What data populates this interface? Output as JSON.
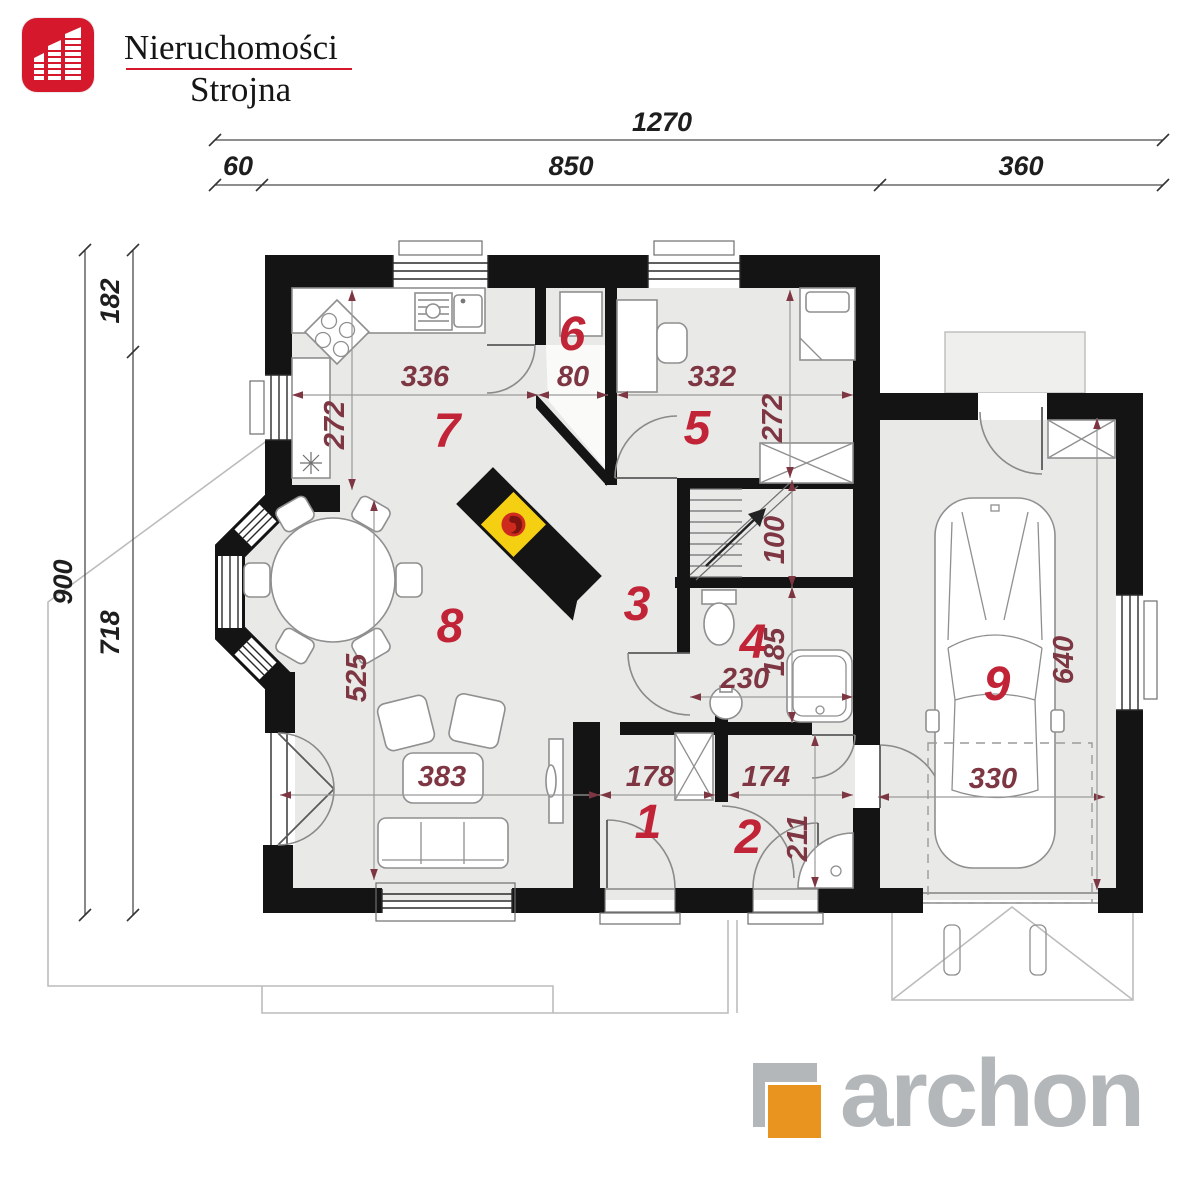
{
  "colors": {
    "accent-red": "#d6182c",
    "wall": "#141414",
    "floor": "#e9e9e7",
    "room-number": "#c22437",
    "dim-red": "#7d3642",
    "fireplace-yellow": "#f5cf12",
    "flame-red": "#cf2a1e",
    "archon-gray": "#b3b7b9",
    "archon-orange": "#e8941f",
    "outline-gray": "#bcbcbc"
  },
  "header_logo": {
    "line1": "Nieruchomości",
    "line2": "Strojna"
  },
  "footer_logo": {
    "text": "archon"
  },
  "outer_dimensions": {
    "total_width": "1270",
    "left_setback": "60",
    "house_width": "850",
    "garage_width": "360",
    "total_depth": "900",
    "upper_depth": "182",
    "lower_depth": "718"
  },
  "interior_dimensions": {
    "kitchen_width": "336",
    "kitchen_depth": "272",
    "pantry_width": "80",
    "bedroom_width": "332",
    "bedroom_depth": "272",
    "living_length": "525",
    "living_width": "383",
    "hall_width": "178",
    "stair_passage": "100",
    "bathroom_depth": "185",
    "bathroom_width": "230",
    "vestibule_width": "174",
    "vestibule_depth": "211",
    "garage_gate_width": "330",
    "garage_depth": "640"
  },
  "rooms": [
    {
      "number": "1"
    },
    {
      "number": "2"
    },
    {
      "number": "3"
    },
    {
      "number": "4"
    },
    {
      "number": "5"
    },
    {
      "number": "6"
    },
    {
      "number": "7"
    },
    {
      "number": "8"
    },
    {
      "number": "9"
    }
  ]
}
